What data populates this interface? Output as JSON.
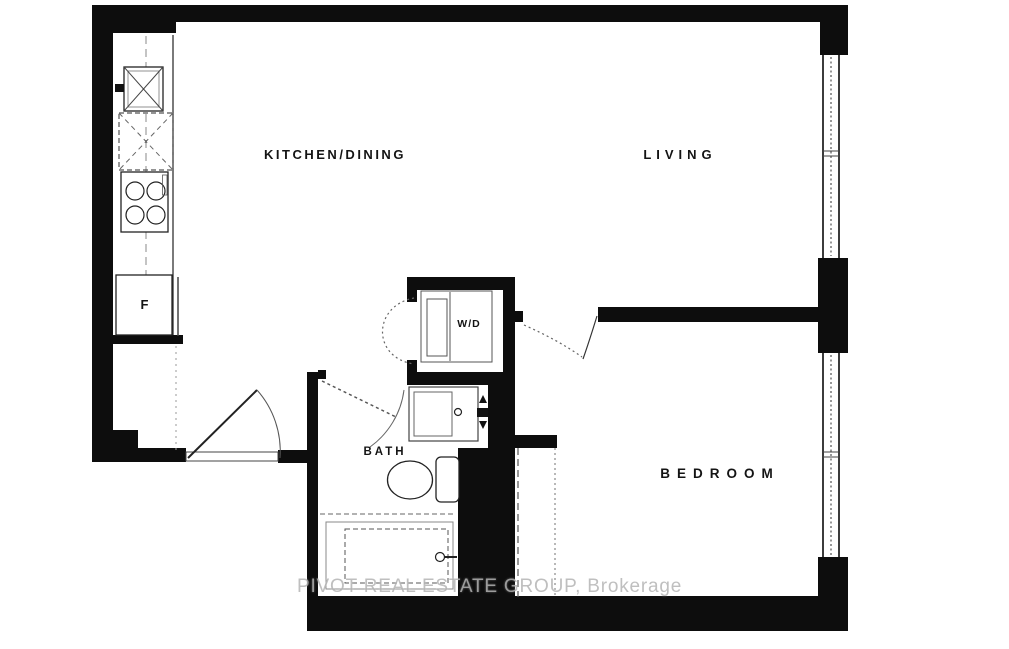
{
  "plan": {
    "rooms": {
      "kitchen_dining": "KITCHEN/DINING",
      "living": "LIVING",
      "bedroom": "BEDROOM",
      "bath": "BATH"
    },
    "fixtures": {
      "washer_dryer": "W/D",
      "fridge": "F"
    },
    "watermark": "PIVOT REAL ESTATE GROUP, Brokerage",
    "colors": {
      "wall": "#0d0d0d",
      "line": "#444444",
      "watermark": "#b5b5b5",
      "background": "#ffffff"
    }
  }
}
